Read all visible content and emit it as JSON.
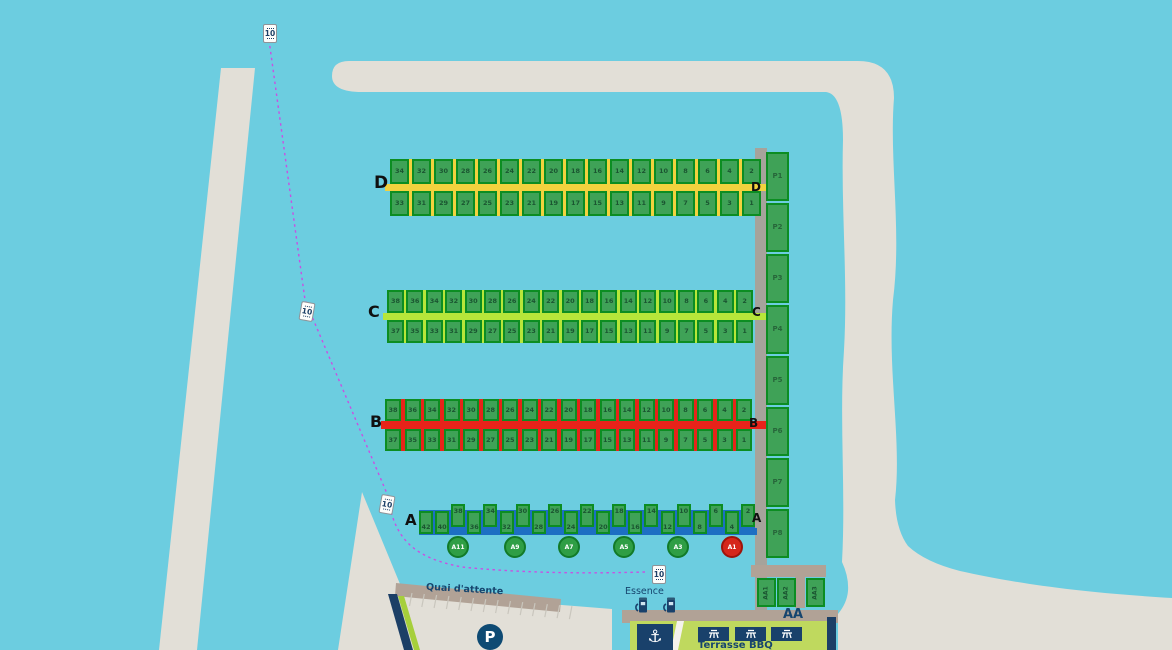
{
  "map": {
    "water_color": "#6ccde0",
    "land_color": "#e2dfd7",
    "quay_color": "#b1a296",
    "pier_color": "#a6a39b",
    "slip_fill": "#3fa257",
    "slip_border": "#0c8d22",
    "navy": "#16456e",
    "terrace_green": "#bfd95e",
    "channel_dash_color": "#c94fe3"
  },
  "docks": [
    {
      "id": "D",
      "label": "D",
      "color": "#f2d23e",
      "top_numbers": [
        34,
        32,
        30,
        28,
        26,
        24,
        22,
        20,
        18,
        16,
        14,
        12,
        10,
        8,
        6,
        4,
        2
      ],
      "bottom_numbers": [
        33,
        31,
        29,
        27,
        25,
        23,
        21,
        19,
        17,
        15,
        13,
        11,
        9,
        7,
        5,
        3,
        1
      ]
    },
    {
      "id": "C",
      "label": "C",
      "color": "#b7e63a",
      "top_numbers": [
        38,
        36,
        34,
        32,
        30,
        28,
        26,
        24,
        22,
        20,
        18,
        16,
        14,
        12,
        10,
        8,
        6,
        4,
        2
      ],
      "bottom_numbers": [
        37,
        35,
        33,
        31,
        29,
        27,
        25,
        23,
        21,
        19,
        17,
        15,
        13,
        11,
        9,
        7,
        5,
        3,
        1
      ]
    },
    {
      "id": "B",
      "label": "B",
      "color": "#e8231a",
      "top_numbers": [
        38,
        36,
        34,
        32,
        30,
        28,
        26,
        24,
        22,
        20,
        18,
        16,
        14,
        12,
        10,
        8,
        6,
        4,
        2
      ],
      "bottom_numbers": [
        37,
        35,
        33,
        31,
        29,
        27,
        25,
        23,
        21,
        19,
        17,
        15,
        13,
        11,
        9,
        7,
        5,
        3,
        1
      ]
    },
    {
      "id": "A",
      "label": "A",
      "color": "#1d6fc3",
      "numbers": [
        42,
        40,
        38,
        36,
        34,
        32,
        30,
        28,
        26,
        24,
        22,
        20,
        18,
        16,
        14,
        12,
        10,
        8,
        6,
        4,
        2
      ]
    }
  ],
  "pier": {
    "slips": [
      "P1",
      "P2",
      "P3",
      "P4",
      "P5",
      "P6",
      "P7",
      "P8"
    ]
  },
  "aa_dock": {
    "label": "AA",
    "slips": [
      "AA1",
      "AA2",
      "AA3"
    ]
  },
  "buoys": [
    {
      "label": "A11",
      "color": "#2f9e45",
      "border": "#127a28"
    },
    {
      "label": "A9",
      "color": "#2f9e45",
      "border": "#127a28"
    },
    {
      "label": "A7",
      "color": "#2f9e45",
      "border": "#127a28"
    },
    {
      "label": "A5",
      "color": "#2f9e45",
      "border": "#127a28"
    },
    {
      "label": "A3",
      "color": "#2f9e45",
      "border": "#127a28"
    },
    {
      "label": "A1",
      "color": "#d5271b",
      "border": "#9d140c"
    }
  ],
  "speed_signs": {
    "label": "10"
  },
  "facilities": {
    "waiting_quay": "Quai d'attente",
    "fuel": "Essence",
    "terrace": "Terrasse BBQ",
    "parking": "P",
    "anchor_glyph": "⚓"
  }
}
